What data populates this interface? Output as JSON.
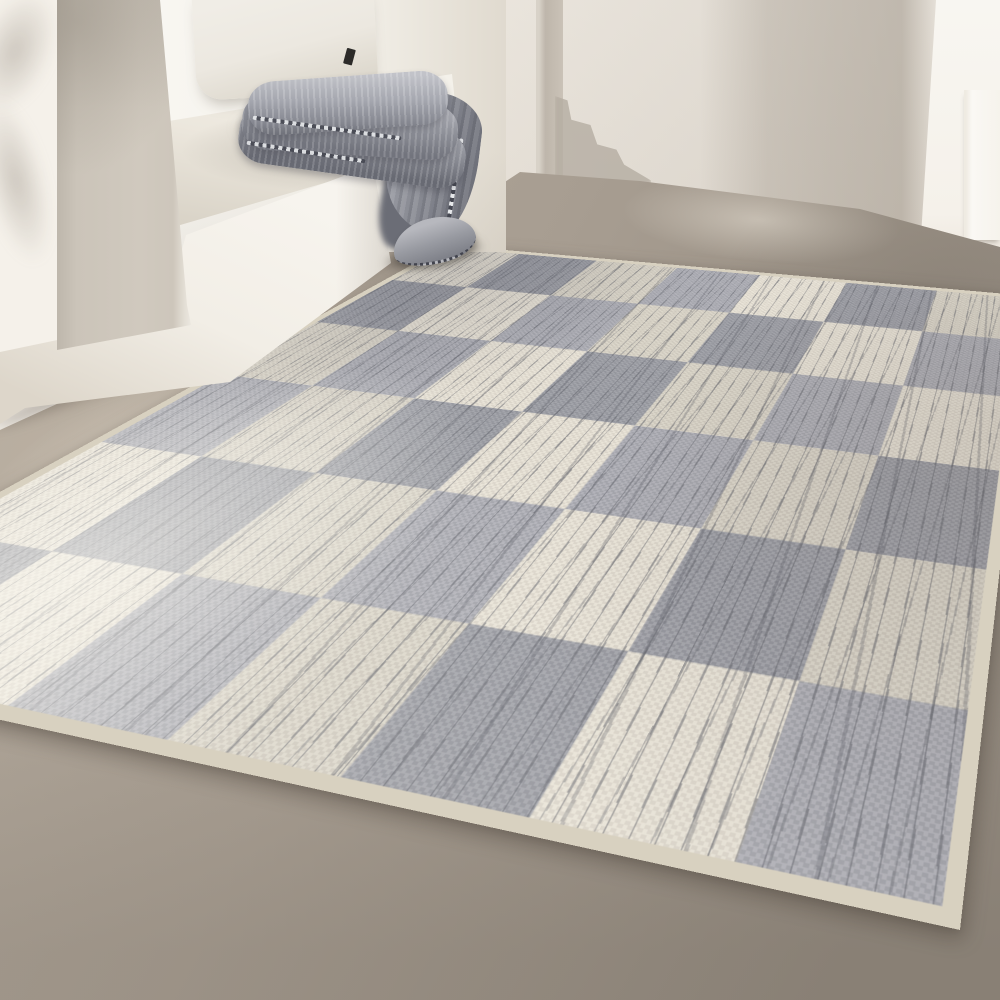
{
  "scene": {
    "setting": "bright minimalist room corner with plaster walls and a polished greige concrete floor",
    "lighting": "warm sunlight from the upper left casting soft foliage shadows and a vertical shadow band on the back wall",
    "objects": [
      {
        "name": "built-in bench niche",
        "parts": [
          "shadowed greige front pillar",
          "sunlit white side wall",
          "white seat base",
          "cream seat cushion",
          "off-white linen pillow",
          "small black fabric tag on pillow"
        ]
      },
      {
        "name": "folded blanket",
        "material": "heather gray wool",
        "details": [
          "three stacked folds on bench edge",
          "drape hanging over the bench corner",
          "contrast whipstitch edging with light ticks",
          "curled tail resting near the floor"
        ]
      },
      {
        "name": "area rug",
        "pattern": "distressed checkerboard",
        "square_colors": [
          "cool gray",
          "cream"
        ],
        "details": [
          "dark scratch streaks across squares",
          "cream binding edge",
          "laid diagonally, near corner toward lower right",
          "soft shadow under near edges"
        ]
      },
      {
        "name": "floor",
        "material": "greige microcement with sunlit patch at lower left"
      },
      {
        "name": "back wall",
        "details": [
          "soft vertical shadow column",
          "shadowed corner reveal with stepped cast shadow",
          "sunlit white wall strip and jamb at right"
        ]
      }
    ]
  },
  "rug": {
    "grid": {
      "columns": 6,
      "rows": 7
    }
  },
  "palette": {
    "wall_main": "#ece6dd",
    "wall_shadow": "#c4bcb1",
    "wall_corner": "#beb6ab",
    "wall_sunlit": "#f8f6f1",
    "wall_left_lit": "#f5f1ea",
    "pillar": "#cbc4b9",
    "pillar_edge": "#f1eee7",
    "niche_back": "#f7f5ef",
    "bench_face": "#f2eee6",
    "bench_face_shade": "#ddd6ca",
    "cushion": "#ece7dd",
    "cushion_shade": "#d8d2c6",
    "pillow": "#ece8e0",
    "pillow_tag": "#2c2b29",
    "floor_light": "#b3a99c",
    "floor_mid": "#a79d91",
    "floor_dark": "#91887d",
    "rug_cream": "#e4decf",
    "rug_gray": "#a2a3aa",
    "rug_binding": "#d8d1c0",
    "rug_scratch": "#5e6068",
    "blanket_light": "#c2c3c9",
    "blanket_mid": "#92949c",
    "blanket_dark": "#6b6d76",
    "stitch_light": "#eceef0",
    "stitch_dark": "#42444e"
  }
}
